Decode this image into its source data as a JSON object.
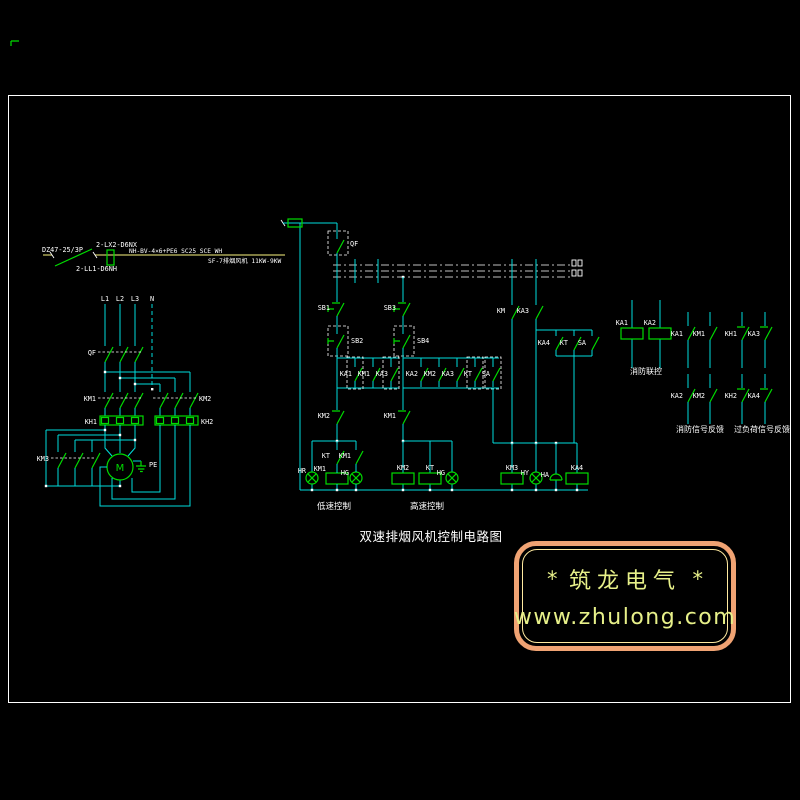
{
  "colors": {
    "wire": "#00dcdc",
    "symbol": "#00dc00",
    "text": "#ffffff",
    "feeder_line": "#a8a455",
    "watermark_border": "#f0a373",
    "watermark_inner_border": "#ffeaa0",
    "watermark_text": "#e7f089"
  },
  "feeder": {
    "breaker": "DZ47-25/3P",
    "switch_spec": "2-LX2-D6NX",
    "fuse_spec": "2-LL1-D6NH",
    "cable_spec": "NH-BV-4×6+PE6 SC25 SCE WH",
    "load_spec": "SF-7排烟风机 11KW-9KW"
  },
  "power": {
    "phases": [
      "L1",
      "L2",
      "L3",
      "N"
    ],
    "breaker": "QF",
    "contactor_low": "KM1",
    "contactor_high": "KM2",
    "thermal_low": "KH1",
    "thermal_high": "KH2",
    "contactor_star": "KM3",
    "motor": "M",
    "earth": "PE"
  },
  "control": {
    "qf_aux": "QF",
    "low": {
      "stop": "SB1",
      "start": "SB2",
      "hold": [
        "KA1",
        "KM1",
        "KA3"
      ],
      "interlock": "KM2",
      "aux": "KT",
      "run": "KM1",
      "lamp_stop": "HR",
      "coil": "KM1",
      "lamp_run": "HG",
      "caption": "低速控制"
    },
    "high": {
      "stop": "SB3",
      "start": "SB4",
      "hold": [
        "KA2",
        "KM2",
        "KA3",
        "KT",
        "SA"
      ],
      "interlock": "KM1",
      "coil": "KM2",
      "timer": "KT",
      "lamp_run": "HG",
      "caption": "高速控制"
    },
    "mid": {
      "c1": "KM",
      "c2": "KA3",
      "r1": "KA4",
      "r2": "KT",
      "r3": "SA",
      "coil_star": "KM3",
      "lamp": "HY",
      "bell": "HA",
      "coil_relay": "KA4"
    }
  },
  "panel": {
    "fire_coils": {
      "c1": "KA1",
      "c2": "KA2",
      "caption": "消防联控"
    },
    "fire_fb": {
      "r1c1": "KA1",
      "r1c2": "KM1",
      "r2c1": "KA2",
      "r2c2": "KM2",
      "caption": "消防信号反馈"
    },
    "overload_fb": {
      "r1c1": "KH1",
      "r1c2": "KA3",
      "r2c1": "KH2",
      "r2c2": "KA4",
      "caption": "过负荷信号反馈"
    }
  },
  "title": "双速排烟风机控制电路图",
  "watermark": {
    "star_left": "*",
    "brand": "筑龙电气",
    "star_right": "*",
    "url": "www.zhulong.com"
  }
}
